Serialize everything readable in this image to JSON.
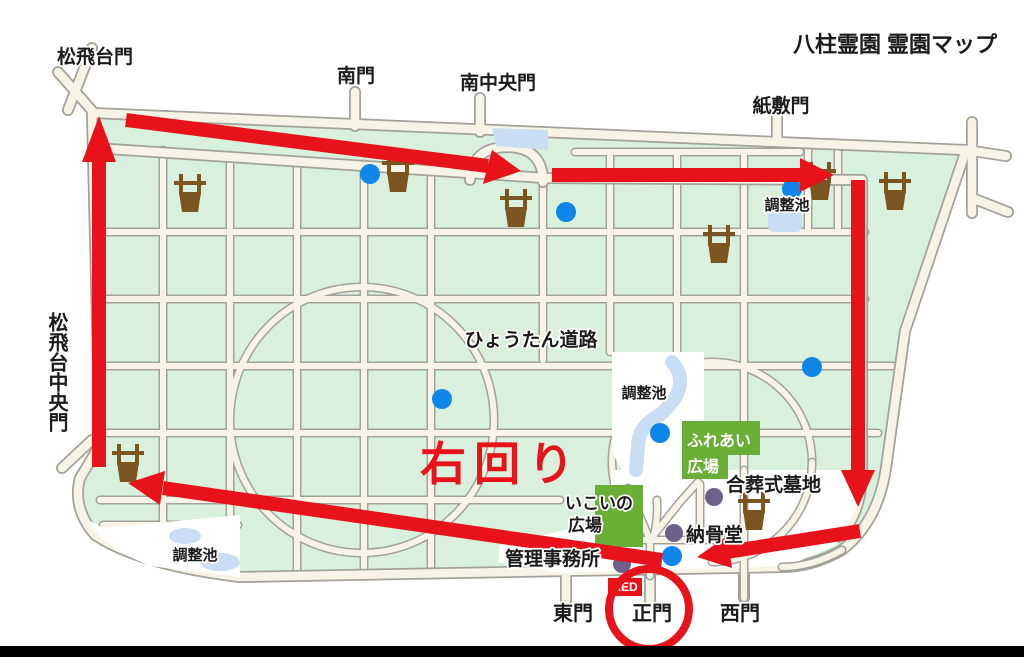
{
  "title": "八柱霊園 霊園マップ",
  "gates": {
    "matsuhidai": "松飛台門",
    "minami": "南門",
    "minami_chuo": "南中央門",
    "kamishiki": "紙敷門",
    "matsuhidai_chuo": "松飛台中央門",
    "higashi": "東門",
    "main": "正門",
    "nishi": "西門"
  },
  "labels": {
    "pond": "調整池",
    "hyotan_road": "ひょうたん道路",
    "fureai_line1": "ふれあい",
    "fureai_line2": "広場",
    "ikoi_line1": "いこいの",
    "ikoi_line2": "広場",
    "gasso_cemetery": "合葬式墓地",
    "nokotsudo": "納骨堂",
    "admin_office": "管理事務所",
    "aed": "AED",
    "clockwise": "右回り"
  },
  "colors": {
    "map_green": "#d9f1dc",
    "road_fill": "#f7f4e6",
    "road_edge": "#a2a29a",
    "plaza_green": "#69ae36",
    "pond_blue": "#c9ddf4",
    "marker_blue": "#1086e8",
    "marker_purple": "#6e6187",
    "water_station_brown": "#7a5520",
    "route_red": "#e8121a",
    "footer_bar": "#000000"
  }
}
